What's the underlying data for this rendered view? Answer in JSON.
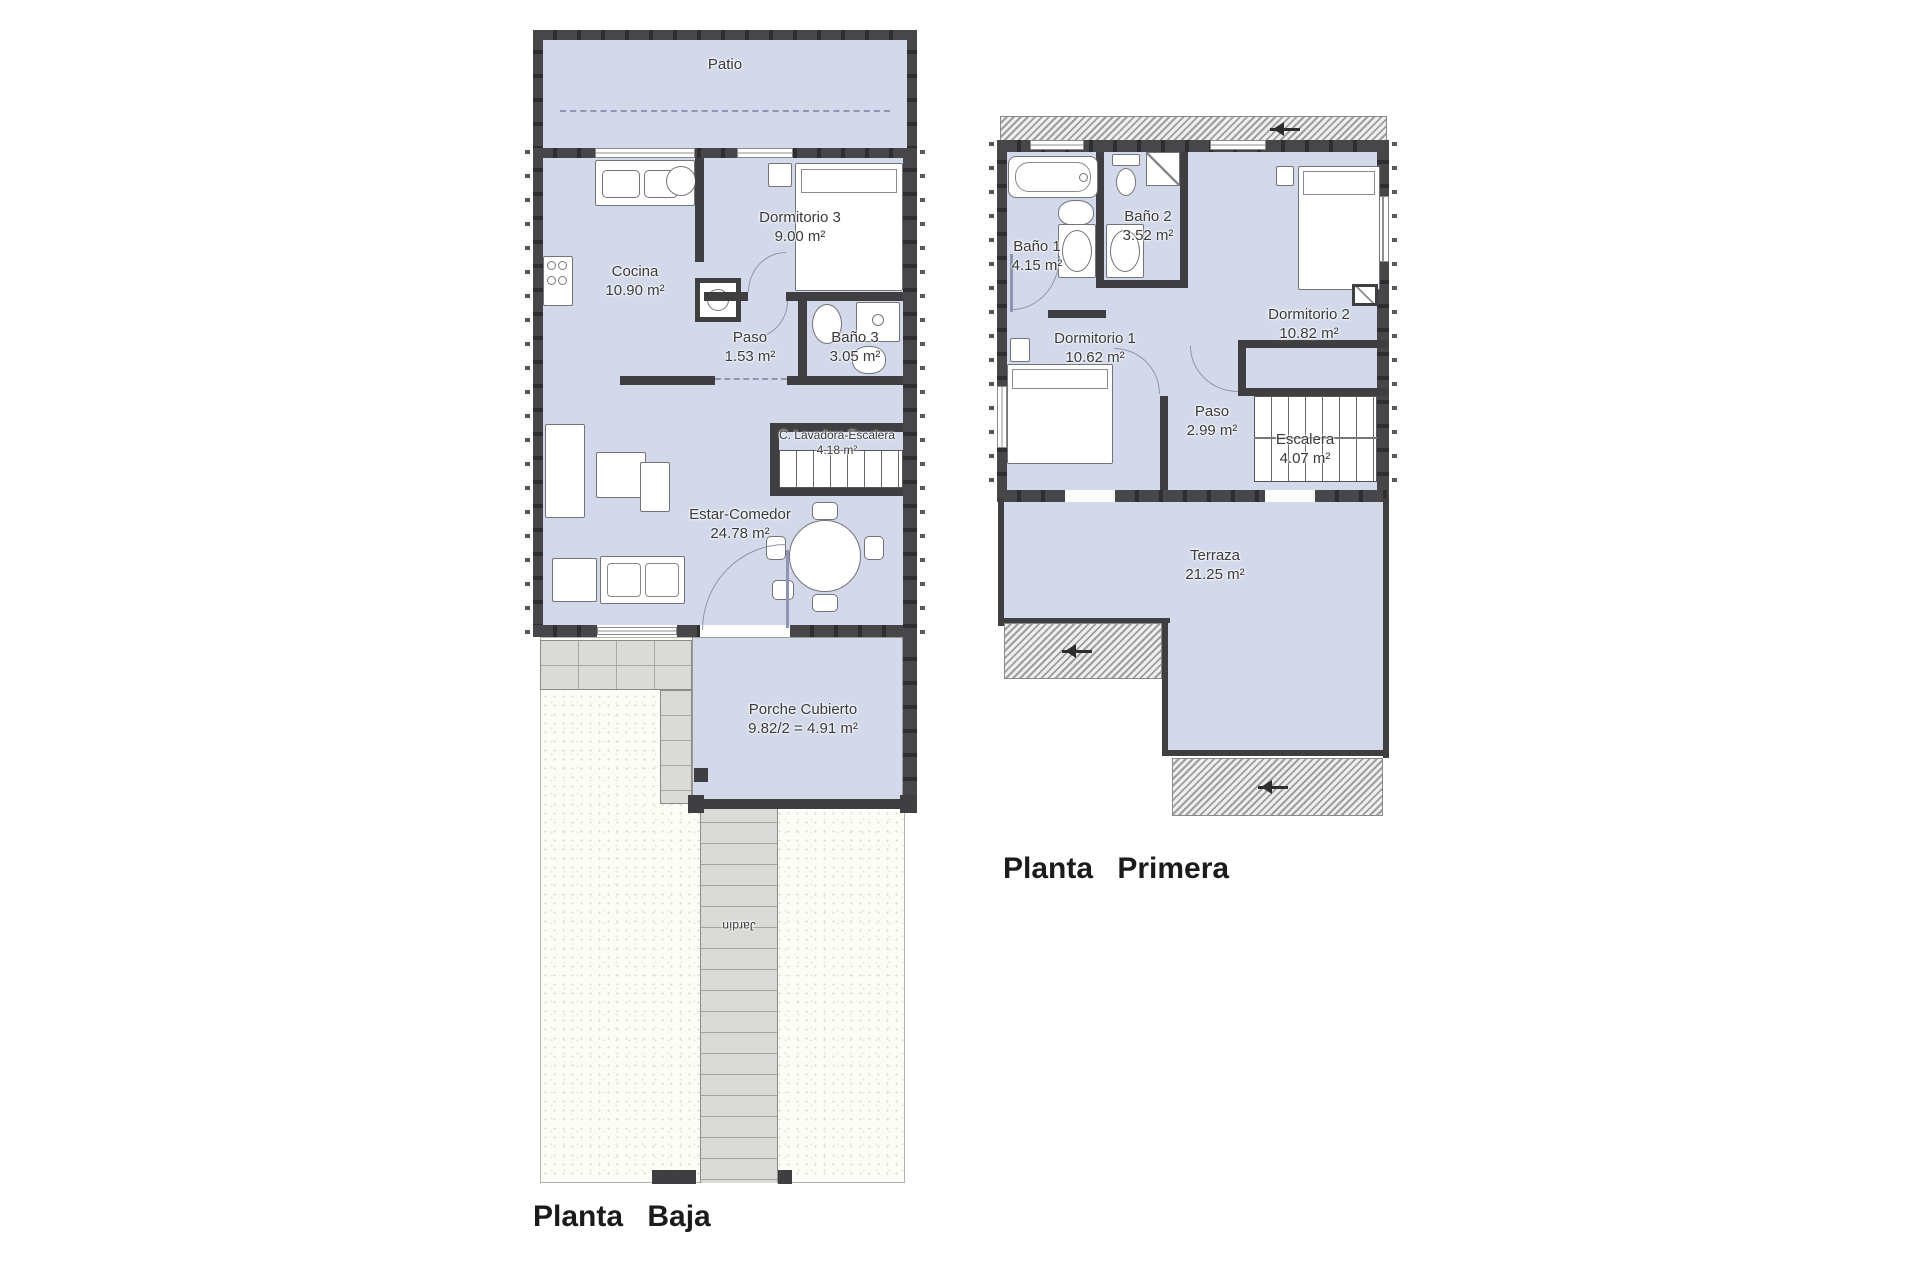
{
  "document": {
    "type": "architectural floor plan"
  },
  "colors": {
    "room_fill": "#d3d9ea",
    "wall": "#3f3f42",
    "paving": "#dadad6",
    "hatch_stripe": "#9d9d9d",
    "title_text": "#1b1b1b",
    "label_text": "#3a3a3a",
    "background": "#ffffff"
  },
  "ground_floor": {
    "title": "Planta Baja",
    "patio": {
      "name": "Patio"
    },
    "cocina": {
      "name": "Cocina",
      "area": "10.90 m²"
    },
    "dormitorio3": {
      "name": "Dormitorio 3",
      "area": "9.00 m²"
    },
    "paso": {
      "name": "Paso",
      "area": "1.53 m²"
    },
    "bano3": {
      "name": "Baño 3",
      "area": "3.05 m²"
    },
    "lavadora": {
      "name": "C. Lavadora-Escalera",
      "area": "4.18 m²"
    },
    "estar": {
      "name": "Estar-Comedor",
      "area": "24.78 m²"
    },
    "porche": {
      "name": "Porche Cubierto",
      "area": "9.82/2 = 4.91 m²"
    },
    "jardin": {
      "name": "Jardín"
    }
  },
  "first_floor": {
    "title": "Planta Primera",
    "bano1": {
      "name": "Baño 1",
      "area": "4.15 m²"
    },
    "bano2": {
      "name": "Baño 2",
      "area": "3.52 m²"
    },
    "dormitorio1": {
      "name": "Dormitorio 1",
      "area": "10.62 m²"
    },
    "dormitorio2": {
      "name": "Dormitorio 2",
      "area": "10.82 m²"
    },
    "paso": {
      "name": "Paso",
      "area": "2.99 m²"
    },
    "escalera": {
      "name": "Escalera",
      "area": "4.07 m²"
    },
    "terraza": {
      "name": "Terraza",
      "area": "21.25 m²"
    }
  }
}
